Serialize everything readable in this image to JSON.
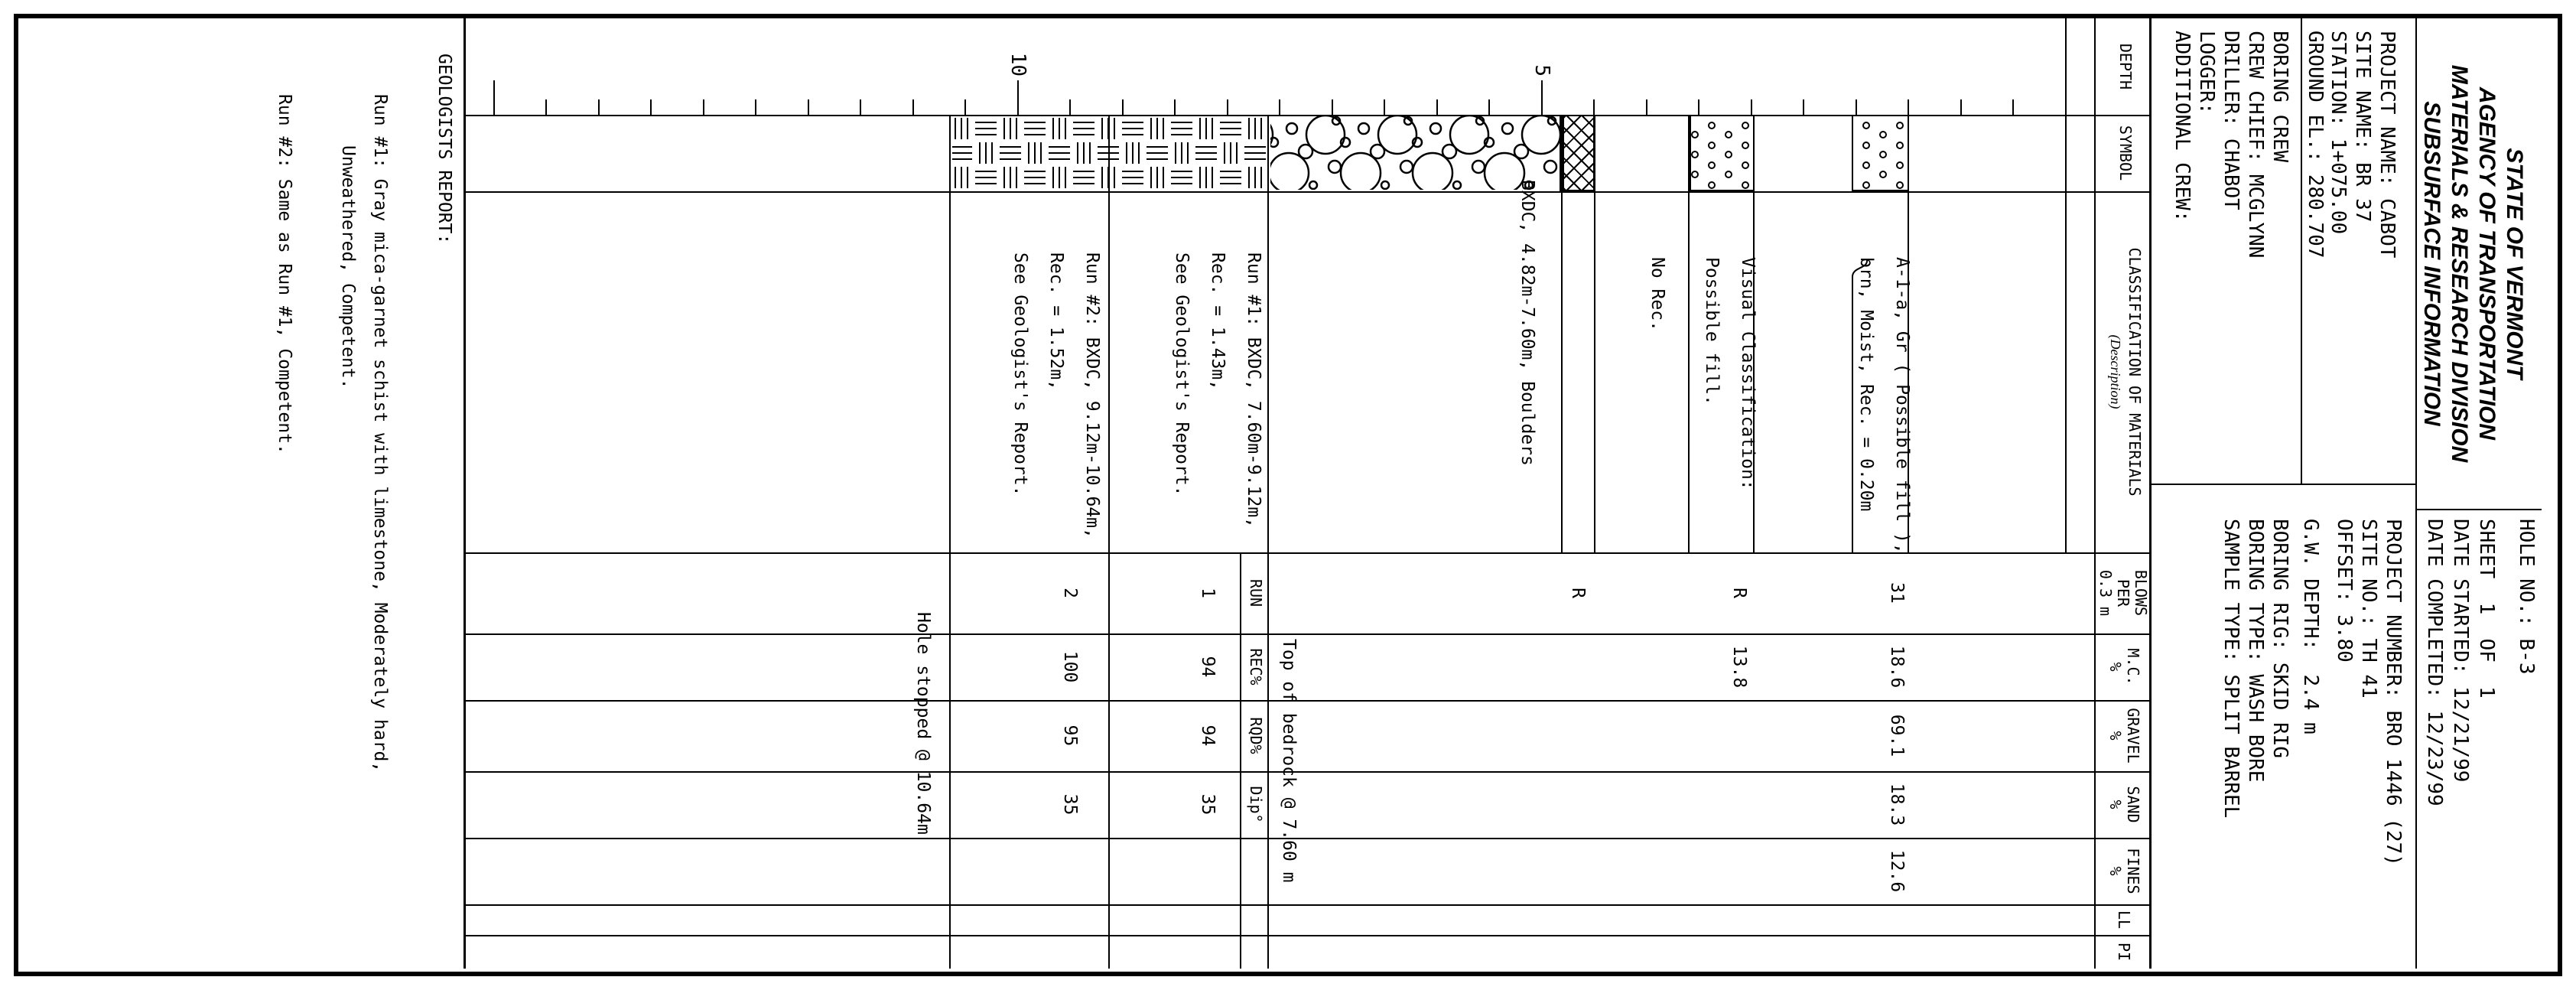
{
  "header": {
    "agency_titles": [
      "STATE OF VERMONT",
      "AGENCY OF TRANSPORTATION",
      "MATERIALS & RESEARCH DIVISION",
      "SUBSURFACE INFORMATION"
    ],
    "project_block": [
      "PROJECT NAME: CABOT",
      "SITE NAME: BR 37",
      "STATION: 1+075.00",
      "GROUND EL.: 280.707"
    ],
    "crew_block": [
      "BORING CREW",
      "CREW CHIEF: MCGLYNN",
      "DRILLER: CHABOT",
      "LOGGER:",
      "ADDITIONAL CREW:"
    ],
    "hole_block": [
      "HOLE NO.: B-3",
      "SHEET  1  OF  1",
      "DATE STARTED: 12/21/99",
      "DATE COMPLETED: 12/23/99"
    ],
    "number_block": [
      "PROJECT NUMBER: BRO 1446 (27)",
      "SITE NO.: TH 41",
      "OFFSET: 3.80",
      "G.W. DEPTH:  2.4 m"
    ],
    "rig_block": [
      "BORING RIG: SKID RIG",
      "BORING TYPE: WASH BORE",
      "SAMPLE TYPE: SPLIT BARREL"
    ]
  },
  "table": {
    "col_depth": "DEPTH",
    "col_symbol": "SYMBOL",
    "col_class": "CLASSIFICATION OF MATERIALS",
    "col_class_sub": "(Description)",
    "col_blows": "BLOWS\nPER\n0.3 m",
    "col_mc": "M.C.\n%",
    "col_gravel": "GRAVEL\n%",
    "col_sand": "SAND\n%",
    "col_fines": "FINES\n%",
    "col_ll": "LL",
    "col_pi": "PI",
    "core_cols": [
      "RUN",
      "REC%",
      "RQD%",
      "Dip°"
    ]
  },
  "log": {
    "depth_labels": {
      "five": "5",
      "ten": "10"
    },
    "descriptions": {
      "layer1": [
        "A-1-a, Gr ( Possible fill ),",
        "brn, Moist, Rec. = 0.20m"
      ],
      "layer2": [
        "Visual Classification:",
        "Possible fill."
      ],
      "layer3": "No Rec.",
      "layer4": "BXDC, 4.82m-7.60m, Boulders",
      "run1": [
        "Run #1: BXDC, 7.60m-9.12m,",
        "Rec. = 1.43m,",
        "See Geologist's Report."
      ],
      "run2": [
        "Run #2: BXDC, 9.12m-10.64m,",
        "Rec. = 1.52m,",
        "See Geologist's Report."
      ]
    },
    "annotations": {
      "bedrock": "Top of bedrock @ 7.60 m",
      "hole_stopped": "Hole stopped @ 10.64m"
    },
    "values": {
      "sample1": {
        "blows": "31",
        "mc": "18.6",
        "gravel": "69.1",
        "sand": "18.3",
        "fines": "12.6"
      },
      "sample2": {
        "blows": "R",
        "mc": "13.8"
      },
      "sample3": {
        "blows": "R"
      },
      "run1": {
        "run": "1",
        "rec": "94",
        "rqd": "94",
        "dip": "35"
      },
      "run2": {
        "run": "2",
        "rec": "100",
        "rqd": "95",
        "dip": "35"
      }
    }
  },
  "geologists_report": {
    "heading": "GEOLOGISTS REPORT:",
    "lines": [
      "Run #1: Gray mica-garnet schist with limestone, Moderately hard,",
      "Unweathered, Competent.",
      "Run #2: Same as Run #1, Competent."
    ]
  }
}
